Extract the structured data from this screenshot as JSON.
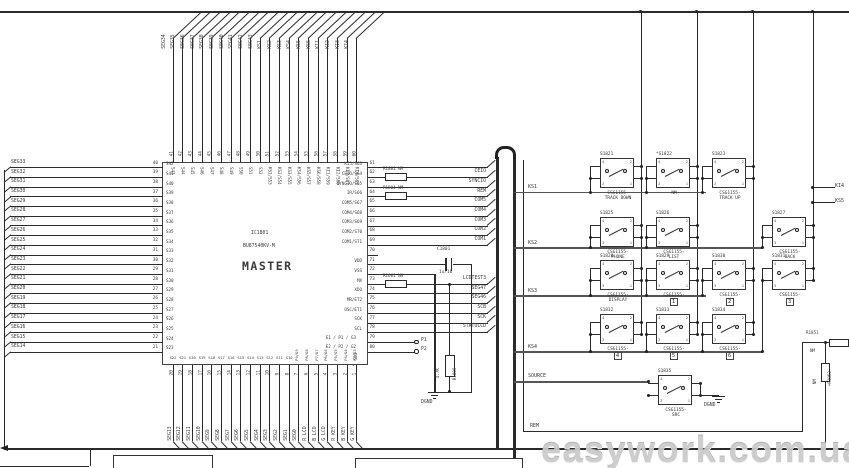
{
  "misc": {
    "ic_ref": "IC1801",
    "ic_part": "BU87540KV-M",
    "ic_name": "MASTER",
    "c1801": "C1801",
    "c1801_val": "1u/16",
    "r1809": "R1809",
    "r1809_val": "4.7K",
    "p1": "P1",
    "p2": "P2",
    "sdi": "SDI",
    "alt79": "E1 / P1 / G3",
    "alt80": "E2 / P2 / G2",
    "dgnd": "DGND",
    "r1851": "R1851",
    "r1851_val": "NM",
    "r1852": "+R1852",
    "r1852_val": "NM",
    "watermark": "easywork.com.ua"
  },
  "left_pins": [
    {
      "net": "SEG33",
      "pin": "40",
      "internal": "S42"
    },
    {
      "net": "SEG32",
      "pin": "39",
      "internal": "S41"
    },
    {
      "net": "SEG31",
      "pin": "38",
      "internal": "S40"
    },
    {
      "net": "SEG30",
      "pin": "37",
      "internal": "S39"
    },
    {
      "net": "SEG29",
      "pin": "36",
      "internal": "S38"
    },
    {
      "net": "SEG28",
      "pin": "35",
      "internal": "S37"
    },
    {
      "net": "SEG27",
      "pin": "34",
      "internal": "S36"
    },
    {
      "net": "SEG26",
      "pin": "33",
      "internal": "S35"
    },
    {
      "net": "SEG25",
      "pin": "32",
      "internal": "S34"
    },
    {
      "net": "SEG24",
      "pin": "31",
      "internal": "S33"
    },
    {
      "net": "SEG23",
      "pin": "30",
      "internal": "S32"
    },
    {
      "net": "SEG22",
      "pin": "29",
      "internal": "S31"
    },
    {
      "net": "SEG21",
      "pin": "28",
      "internal": "S30"
    },
    {
      "net": "SEG20",
      "pin": "27",
      "internal": "S29"
    },
    {
      "net": "SEG19",
      "pin": "26",
      "internal": "S28"
    },
    {
      "net": "SEG18",
      "pin": "25",
      "internal": "S27"
    },
    {
      "net": "SEG17",
      "pin": "24",
      "internal": "S26"
    },
    {
      "net": "SEG16",
      "pin": "23",
      "internal": "S25"
    },
    {
      "net": "SEG15",
      "pin": "22",
      "internal": "S24"
    },
    {
      "net": "SEG14",
      "pin": "21",
      "internal": "S23"
    }
  ],
  "top_pins": [
    {
      "net": "SEG34",
      "pin": "41",
      "internal": "S43"
    },
    {
      "net": "SEG35",
      "pin": "42",
      "internal": "S44"
    },
    {
      "net": "SEG36",
      "pin": "43",
      "internal": "S45"
    },
    {
      "net": "SEG37",
      "pin": "44",
      "internal": "S46"
    },
    {
      "net": "SEG38",
      "pin": "45",
      "internal": "S47"
    },
    {
      "net": "SEG39",
      "pin": "46",
      "internal": "S48"
    },
    {
      "net": "SEG40",
      "pin": "47",
      "internal": "S49"
    },
    {
      "net": "SEG41",
      "pin": "48",
      "internal": "S50"
    },
    {
      "net": "SEG42",
      "pin": "49",
      "internal": "S51"
    },
    {
      "net": "SEG43",
      "pin": "50",
      "internal": "S52"
    },
    {
      "net": "KS1",
      "pin": "51",
      "internal": "KS1/S53"
    },
    {
      "net": "KS2",
      "pin": "52",
      "internal": "KS2/S54"
    },
    {
      "net": "KS3",
      "pin": "53",
      "internal": "KS3/S55"
    },
    {
      "net": "KS4",
      "pin": "54",
      "internal": "KS4/S56"
    },
    {
      "net": "KS5",
      "pin": "55",
      "internal": "KS5/S57"
    },
    {
      "net": "KS6",
      "pin": "56",
      "internal": "KS6/S58"
    },
    {
      "net": "KI1",
      "pin": "57",
      "internal": "KI1/S59"
    },
    {
      "net": "KI2",
      "pin": "58",
      "internal": "KI2/S60"
    },
    {
      "net": "KI3",
      "pin": "59",
      "internal": "KI3/S61"
    },
    {
      "net": "KI4",
      "pin": "60",
      "internal": "KI4/S62"
    }
  ],
  "bottom_pins": [
    {
      "net": "SEG13",
      "pin": "20",
      "internal": "S22",
      "rot": false
    },
    {
      "net": "SEG12",
      "pin": "19",
      "internal": "S21",
      "rot": false
    },
    {
      "net": "SEG11",
      "pin": "18",
      "internal": "S20",
      "rot": false
    },
    {
      "net": "SEG10",
      "pin": "17",
      "internal": "S19",
      "rot": false
    },
    {
      "net": "SEG9",
      "pin": "16",
      "internal": "S18",
      "rot": false
    },
    {
      "net": "SEG8",
      "pin": "15",
      "internal": "S17",
      "rot": false
    },
    {
      "net": "SEG7",
      "pin": "14",
      "internal": "S16",
      "rot": false
    },
    {
      "net": "SEG6",
      "pin": "13",
      "internal": "S15",
      "rot": false
    },
    {
      "net": "SEG5",
      "pin": "12",
      "internal": "S14",
      "rot": false
    },
    {
      "net": "SEG4",
      "pin": "11",
      "internal": "S13",
      "rot": false
    },
    {
      "net": "SEG3",
      "pin": "10",
      "internal": "S12",
      "rot": false
    },
    {
      "net": "SEG2",
      "pin": "9",
      "internal": "S11",
      "rot": false
    },
    {
      "net": "SEG1",
      "pin": "8",
      "internal": "S10",
      "rot": false
    },
    {
      "net": "SEG0",
      "pin": "7",
      "internal": "P9/G9",
      "rot": true
    },
    {
      "net": "R LCD",
      "pin": "6",
      "internal": "P8/G8",
      "rot": true
    },
    {
      "net": "B LCD",
      "pin": "5",
      "internal": "P7/G7",
      "rot": true
    },
    {
      "net": "G LCD",
      "pin": "4",
      "internal": "P6/G6",
      "rot": true
    },
    {
      "net": "R KEY",
      "pin": "3",
      "internal": "P5/G5",
      "rot": true
    },
    {
      "net": "B KEY",
      "pin": "2",
      "internal": "P4/G4",
      "rot": true
    },
    {
      "net": "G KEY",
      "pin": "1",
      "internal": "P3/G3",
      "rot": true
    }
  ],
  "right_pins": [
    {
      "pin": "61",
      "internal": "KI5/S63",
      "net": "",
      "res": ""
    },
    {
      "pin": "62",
      "internal": "CEIO/S64",
      "net": "CEIO",
      "res": "R1801  NM"
    },
    {
      "pin": "63",
      "internal": "SYNCIO/S65",
      "net": "SYNCIO",
      "res": ""
    },
    {
      "pin": "64",
      "internal": "IR/S66",
      "net": "REM",
      "res": "R1804  NM"
    },
    {
      "pin": "65",
      "internal": "COM5/S67",
      "net": "COM5",
      "res": ""
    },
    {
      "pin": "66",
      "internal": "COM4/S68",
      "net": "COM4",
      "res": ""
    },
    {
      "pin": "67",
      "internal": "COM3/S69",
      "net": "COM3",
      "res": ""
    },
    {
      "pin": "68",
      "internal": "COM2/S70",
      "net": "COM2",
      "res": ""
    },
    {
      "pin": "69",
      "internal": "COM1/S71",
      "net": "COM1",
      "res": ""
    },
    {
      "pin": "70",
      "internal": "",
      "net": "",
      "res": ""
    },
    {
      "pin": "71",
      "internal": "VDD",
      "net": "",
      "res": ""
    },
    {
      "pin": "72",
      "internal": "VSS",
      "net": "",
      "res": ""
    },
    {
      "pin": "73",
      "internal": "MX",
      "net": "LCDTEST3",
      "res": "R1601  NM"
    },
    {
      "pin": "74",
      "internal": "XDO",
      "net": "SEG47",
      "res": ""
    },
    {
      "pin": "75",
      "internal": "MR/ET2",
      "net": "SEG46",
      "res": ""
    },
    {
      "pin": "76",
      "internal": "OSC/ET1",
      "net": "SCB",
      "res": ""
    },
    {
      "pin": "77",
      "internal": "SCK",
      "net": "SCK",
      "res": ""
    },
    {
      "pin": "78",
      "internal": "SCL",
      "net": "STATOLCD",
      "res": ""
    },
    {
      "pin": "79",
      "internal": "",
      "net": "",
      "res": ""
    },
    {
      "pin": "80",
      "internal": "",
      "net": "",
      "res": ""
    }
  ],
  "rails": [
    "KS1",
    "KS2",
    "KS3",
    "KS4",
    "SOURCE",
    "REM"
  ],
  "edge_labels": [
    "KI4",
    "KS5"
  ],
  "switch_pins": [
    "4",
    "2",
    "3",
    "1"
  ],
  "switches": [
    {
      "ref": "S1821",
      "part": "CSG1155-",
      "func": "TRACK DOWN",
      "icon": ""
    },
    {
      "ref": "*S1822",
      "part": "NM",
      "func": "",
      "icon": ""
    },
    {
      "ref": "S1823",
      "part": "CSG1155-",
      "func": "TRACK UP",
      "icon": ""
    },
    {
      "ref": "S1825",
      "part": "CSG1155-",
      "func": "PHONE",
      "icon": ""
    },
    {
      "ref": "S1826",
      "part": "CSG1155-",
      "func": "LIST",
      "icon": ""
    },
    {
      "ref": "S1827",
      "part": "CSG1155-",
      "func": "BACK",
      "icon": ""
    },
    {
      "ref": "S1828",
      "part": "CSG1155-",
      "func": "DISPLAY",
      "icon": ""
    },
    {
      "ref": "S1829",
      "part": "CSG1155-",
      "func": "",
      "icon": "1"
    },
    {
      "ref": "S1830",
      "part": "CSG1155-",
      "func": "",
      "icon": "2"
    },
    {
      "ref": "S1831",
      "part": "CSG1155-",
      "func": "",
      "icon": "3"
    },
    {
      "ref": "S1832",
      "part": "CSG1155-",
      "func": "",
      "icon": "4"
    },
    {
      "ref": "S1833",
      "part": "CSG1155-",
      "func": "",
      "icon": "5"
    },
    {
      "ref": "S1834",
      "part": "CSG1155-",
      "func": "",
      "icon": "6"
    },
    {
      "ref": "S1835",
      "part": "CSG1155-",
      "func": "SRC",
      "icon": ""
    }
  ]
}
